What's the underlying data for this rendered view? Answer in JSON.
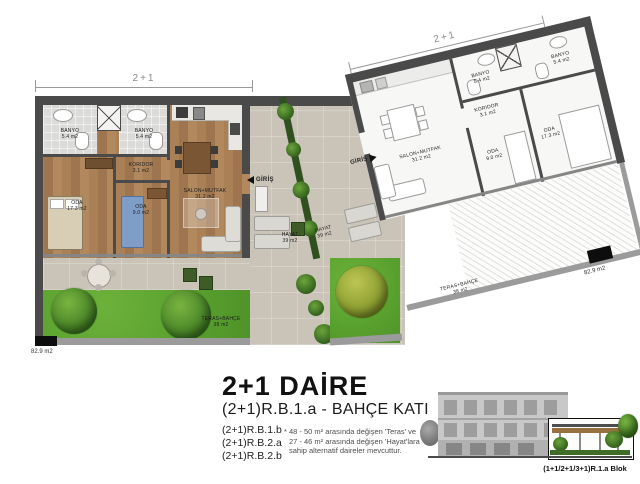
{
  "plan": {
    "dims": {
      "left_width_label": "2+1",
      "right_width_label": "2+1"
    },
    "areas": {
      "left_total": "82.9 m2",
      "right_total": "82.9 m2"
    },
    "entrance_label": "GİRİŞ",
    "rooms": {
      "banyo1": {
        "name": "BANYO",
        "area": "5.4 m2"
      },
      "banyo2": {
        "name": "BANYO",
        "area": "5.4 m2"
      },
      "koridor": {
        "name": "KORIDOR",
        "area": "3.1 m2"
      },
      "oda_small": {
        "name": "ODA",
        "area": "9.0 m2"
      },
      "oda_big": {
        "name": "ODA",
        "area": "17.3 m2"
      },
      "salon": {
        "name": "SALON+MUTFAK",
        "area": "31.2 m2"
      },
      "hayat": {
        "name": "HAYAT",
        "area": "39 m2"
      },
      "teras": {
        "name": "TERAS+BAHÇE",
        "area": "38 m2"
      }
    }
  },
  "footer": {
    "title": "2+1 DAİRE",
    "subtitle": "(2+1)R.B.1.a - BAHÇE KATI",
    "variants": [
      "(2+1)R.B.1.b",
      "(2+1)R.B.2.a",
      "(2+1)R.B.2.b"
    ],
    "note": [
      "* 48 - 50 m² arasında değişen 'Teras' ve",
      "27 - 46 m² arasında değişen 'Hayat'lara",
      "sahip alternatif daireler mevcuttur."
    ],
    "block_caption": "(1+1/2+1/3+1)R.1.a Blok"
  },
  "colors": {
    "wall": "#4a4a4a",
    "wood_floor": "#aa8057",
    "stone": "#c9c3b8",
    "grass": "#58a02e",
    "tile": "#dbdbd9",
    "white_floor": "#f7f7f5",
    "highlight_green": "#3f6d28"
  }
}
